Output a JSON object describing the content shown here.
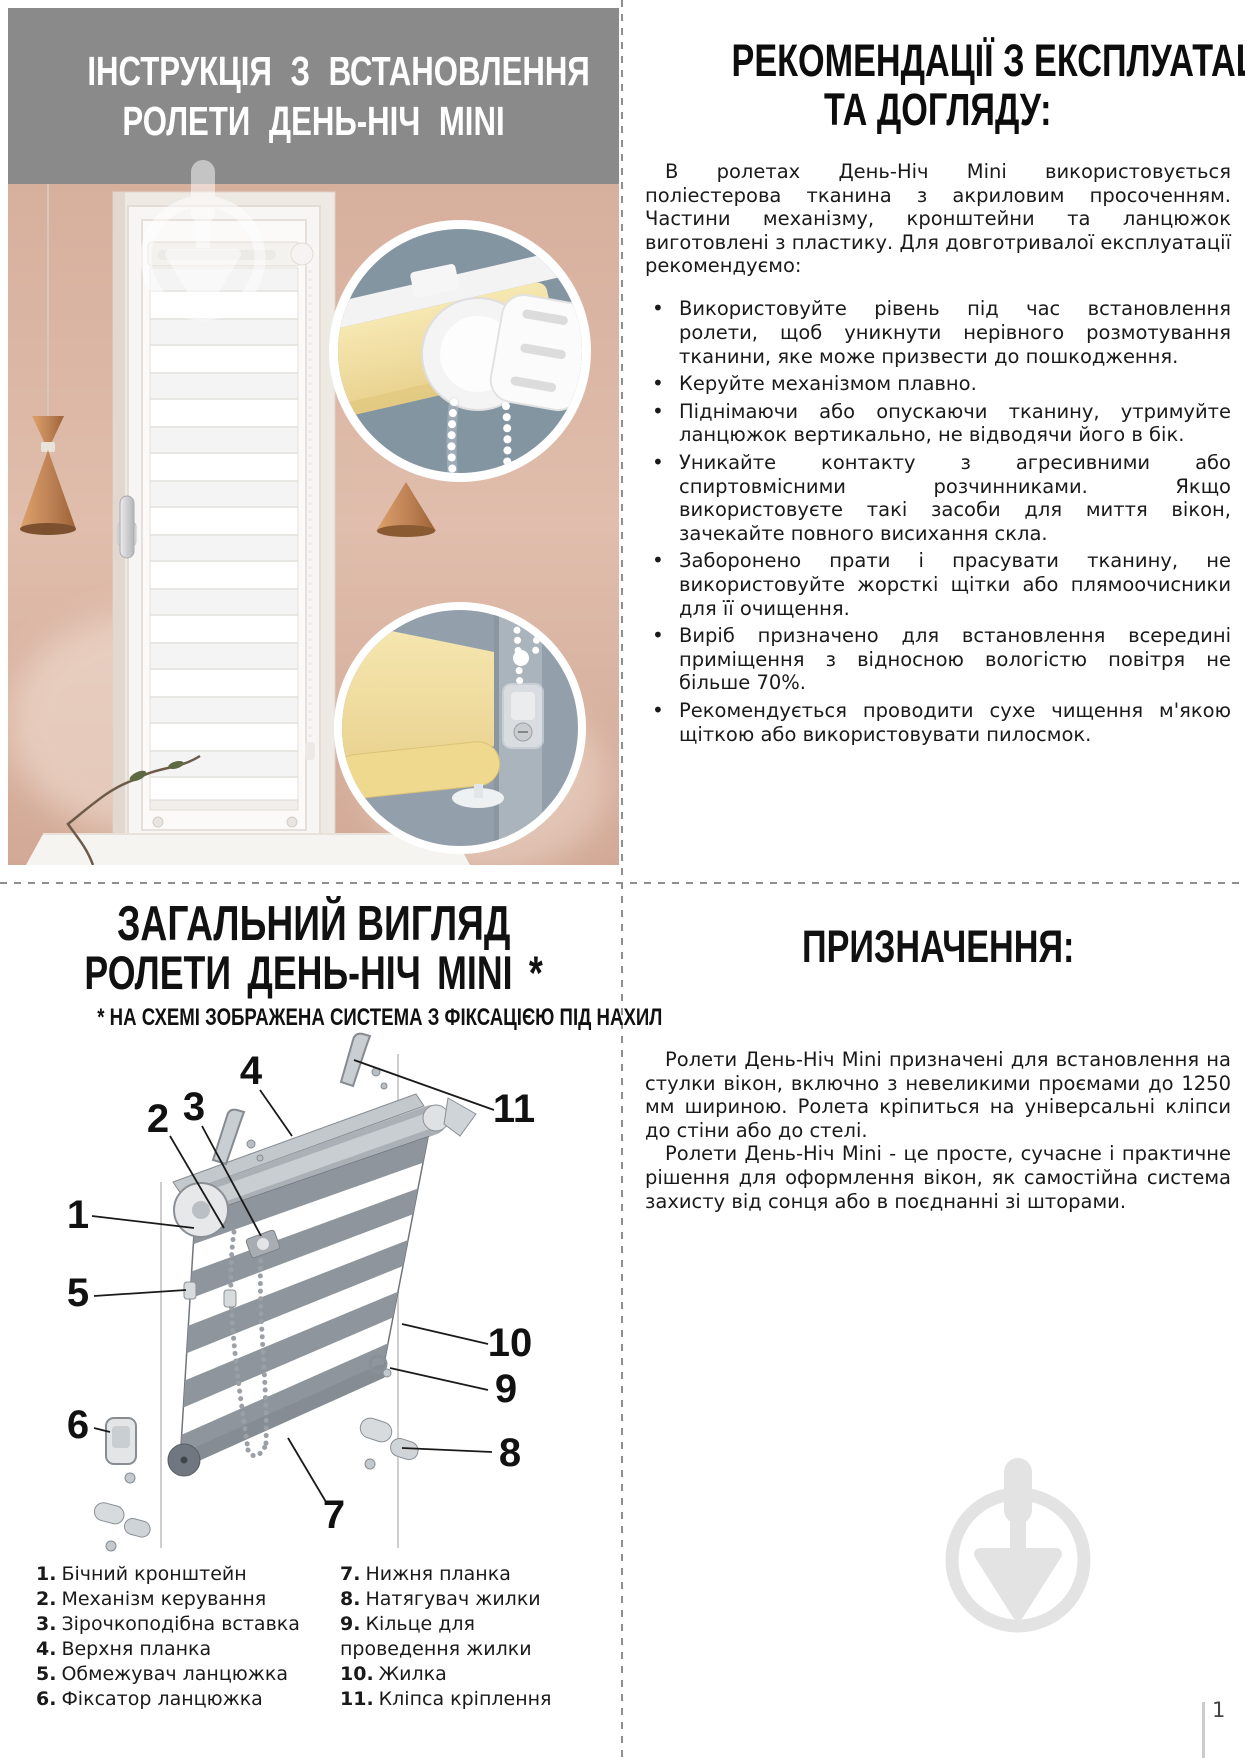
{
  "install_header": {
    "title_line1": "ІНСТРУКЦІЯ З ВСТАНОВЛЕННЯ",
    "title_line2": "РОЛЕТИ ДЕНЬ-НІЧ MINI"
  },
  "recommendations": {
    "title_line1": "РЕКОМЕНДАЦІЇ З ЕКСПЛУАТАЦІЇ",
    "title_line2": "ТА ДОГЛЯДУ:",
    "intro": "В ролетах День-Ніч Mini використовується поліестерова тканина з акриловим просоченням. Частини механізму, кронштейни та ланцюжок виготовлені з пластику. Для довготривалої експлуатації рекомендуємо:",
    "bullets": [
      "Використовуйте рівень під час встановлення ролети, щоб уникнути нерівного розмотування тканини, яке може призвести до пошкодження.",
      "Керуйте механізмом плавно.",
      "Піднімаючи або опускаючи тканину, утримуйте ланцюжок вертикально, не відводячи його в бік.",
      "Уникайте контакту з агресивними або спиртовмісними розчинниками. Якщо використовуєте такі засоби для миття вікон, зачекайте повного висихання скла.",
      "Заборонено прати і прасувати тканину, не використовуйте жорсткі щітки або плямоочисники для її очищення.",
      "Виріб призначено для встановлення всередині приміщення з відносною вологістю повітря не більше 70%.",
      "Рекомендується проводити сухе чищення м'якою щіткою або використовувати пилосмок."
    ]
  },
  "overview": {
    "title_line1": "ЗАГАЛЬНИЙ ВИГЛЯД",
    "title_line2": "РОЛЕТИ ДЕНЬ-НІЧ MINI *",
    "note": "* НА СХЕМІ ЗОБРАЖЕНА СИСТЕМА З ФІКСАЦІЄЮ ПІД НАХИЛ",
    "callouts": [
      "1",
      "2",
      "3",
      "4",
      "5",
      "6",
      "7",
      "8",
      "9",
      "10",
      "11"
    ],
    "legend_left": [
      {
        "num": "1.",
        "label": "Бічний кронштейн"
      },
      {
        "num": "2.",
        "label": "Механізм керування"
      },
      {
        "num": "3.",
        "label": "Зірочкоподібна вставка"
      },
      {
        "num": "4.",
        "label": "Верхня планка"
      },
      {
        "num": "5.",
        "label": "Обмежувач ланцюжка"
      },
      {
        "num": "6.",
        "label": "Фіксатор ланцюжка"
      }
    ],
    "legend_right": [
      {
        "num": "7.",
        "label": "Нижня планка"
      },
      {
        "num": "8.",
        "label": "Натягувач жилки"
      },
      {
        "num": "9.",
        "label": "Кільце для проведення жилки"
      },
      {
        "num": "10.",
        "label": "Жилка"
      },
      {
        "num": "11.",
        "label": "Кліпса кріплення"
      }
    ]
  },
  "purpose": {
    "title": "ПРИЗНАЧЕННЯ:",
    "p1": "Ролети День-Ніч Mini призначені для встановлення на стулки вікон, включно з невеликими проємами до 1250 мм шириною. Ролета кріпиться на універсальні кліпси до стіни або до стелі.",
    "p2": "Ролети День-Ніч Mini - це просте, сучасне і практичне рішення для оформлення вікон, як самостійна система захисту від сонця або в поєднанні зі шторами."
  },
  "footer": {
    "page_number": "1"
  },
  "colors": {
    "header_bg": "#8a8a8a",
    "wall_pink": "#dcb5a3",
    "inset_slate": "#8495a2",
    "fabric_yellow": "#f1dfa2",
    "copper": "#c08457",
    "watermark_gray": "#e3e3e3"
  }
}
